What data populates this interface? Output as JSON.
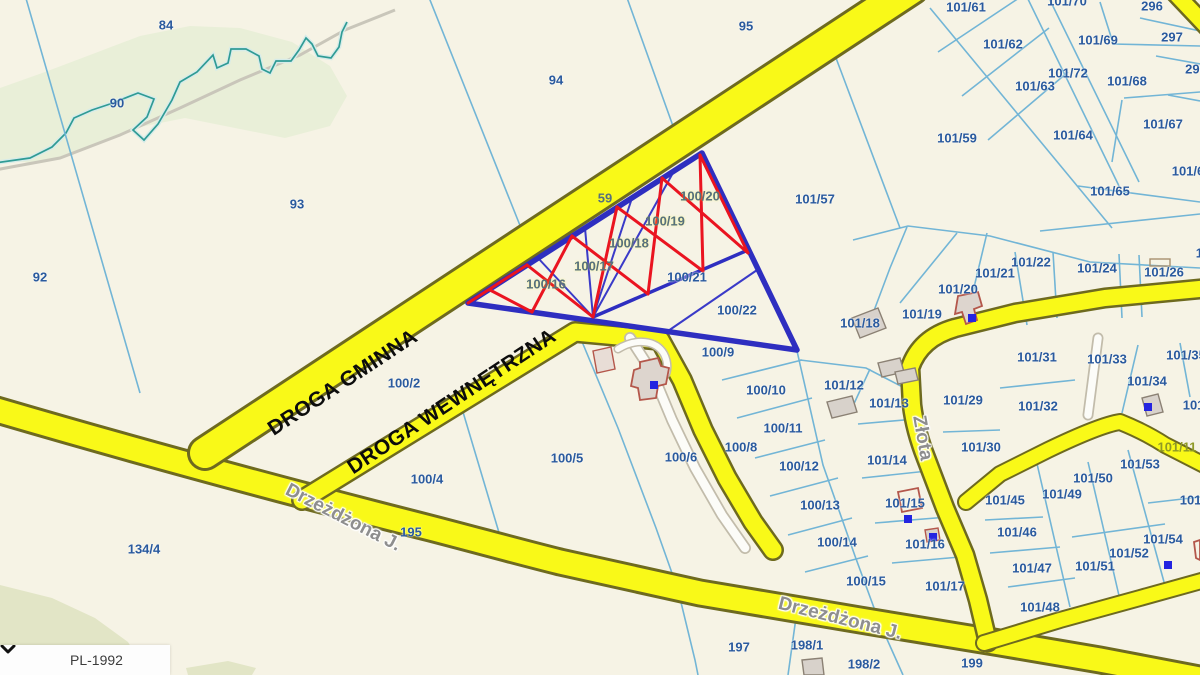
{
  "map": {
    "crs_selector": {
      "value": "PL-1992"
    },
    "labels": [
      {
        "text": "84",
        "x": 166,
        "y": 25,
        "kind": "parcel"
      },
      {
        "text": "90",
        "x": 117,
        "y": 103,
        "kind": "parcel"
      },
      {
        "text": "92",
        "x": 40,
        "y": 277,
        "kind": "parcel"
      },
      {
        "text": "93",
        "x": 297,
        "y": 204,
        "kind": "parcel"
      },
      {
        "text": "94",
        "x": 556,
        "y": 80,
        "kind": "parcel"
      },
      {
        "text": "95",
        "x": 746,
        "y": 26,
        "kind": "parcel"
      },
      {
        "text": "59",
        "x": 605,
        "y": 198,
        "kind": "parcel-muted"
      },
      {
        "text": "100/20",
        "x": 700,
        "y": 196,
        "kind": "parcel-muted"
      },
      {
        "text": "100/19",
        "x": 665,
        "y": 221,
        "kind": "parcel-muted"
      },
      {
        "text": "100/18",
        "x": 629,
        "y": 243,
        "kind": "parcel-muted"
      },
      {
        "text": "100/17",
        "x": 594,
        "y": 266,
        "kind": "parcel-muted"
      },
      {
        "text": "100/16",
        "x": 546,
        "y": 284,
        "kind": "parcel-muted"
      },
      {
        "text": "100/21",
        "x": 687,
        "y": 277,
        "kind": "parcel"
      },
      {
        "text": "100/22",
        "x": 737,
        "y": 310,
        "kind": "parcel"
      },
      {
        "text": "100/9",
        "x": 718,
        "y": 352,
        "kind": "parcel"
      },
      {
        "text": "101/57",
        "x": 815,
        "y": 199,
        "kind": "parcel"
      },
      {
        "text": "100/2",
        "x": 404,
        "y": 383,
        "kind": "parcel"
      },
      {
        "text": "100/4",
        "x": 427,
        "y": 479,
        "kind": "parcel"
      },
      {
        "text": "100/5",
        "x": 567,
        "y": 458,
        "kind": "parcel"
      },
      {
        "text": "100/6",
        "x": 681,
        "y": 457,
        "kind": "parcel"
      },
      {
        "text": "134/4",
        "x": 144,
        "y": 549,
        "kind": "parcel"
      },
      {
        "text": "195",
        "x": 411,
        "y": 532,
        "kind": "parcel"
      },
      {
        "text": "100/8",
        "x": 741,
        "y": 447,
        "kind": "parcel"
      },
      {
        "text": "100/10",
        "x": 766,
        "y": 390,
        "kind": "parcel"
      },
      {
        "text": "100/11",
        "x": 783,
        "y": 428,
        "kind": "parcel"
      },
      {
        "text": "100/12",
        "x": 799,
        "y": 466,
        "kind": "parcel"
      },
      {
        "text": "100/13",
        "x": 820,
        "y": 505,
        "kind": "parcel"
      },
      {
        "text": "100/14",
        "x": 837,
        "y": 542,
        "kind": "parcel"
      },
      {
        "text": "100/15",
        "x": 866,
        "y": 581,
        "kind": "parcel"
      },
      {
        "text": "197",
        "x": 739,
        "y": 647,
        "kind": "parcel"
      },
      {
        "text": "198/1",
        "x": 807,
        "y": 645,
        "kind": "parcel"
      },
      {
        "text": "198/2",
        "x": 864,
        "y": 664,
        "kind": "parcel"
      },
      {
        "text": "199",
        "x": 972,
        "y": 663,
        "kind": "parcel"
      },
      {
        "text": "101/12",
        "x": 844,
        "y": 385,
        "kind": "parcel"
      },
      {
        "text": "101/13",
        "x": 889,
        "y": 403,
        "kind": "parcel"
      },
      {
        "text": "101/14",
        "x": 887,
        "y": 460,
        "kind": "parcel"
      },
      {
        "text": "101/15",
        "x": 905,
        "y": 503,
        "kind": "parcel"
      },
      {
        "text": "101/16",
        "x": 925,
        "y": 544,
        "kind": "parcel"
      },
      {
        "text": "101/17",
        "x": 945,
        "y": 586,
        "kind": "parcel"
      },
      {
        "text": "101/18",
        "x": 860,
        "y": 323,
        "kind": "parcel"
      },
      {
        "text": "101/19",
        "x": 922,
        "y": 314,
        "kind": "parcel"
      },
      {
        "text": "101/20",
        "x": 958,
        "y": 289,
        "kind": "parcel"
      },
      {
        "text": "101/21",
        "x": 995,
        "y": 273,
        "kind": "parcel"
      },
      {
        "text": "101/22",
        "x": 1031,
        "y": 262,
        "kind": "parcel"
      },
      {
        "text": "101/24",
        "x": 1097,
        "y": 268,
        "kind": "parcel"
      },
      {
        "text": "101/26",
        "x": 1164,
        "y": 272,
        "kind": "parcel"
      },
      {
        "text": "101/29",
        "x": 963,
        "y": 400,
        "kind": "parcel"
      },
      {
        "text": "101/30",
        "x": 981,
        "y": 447,
        "kind": "parcel"
      },
      {
        "text": "101/31",
        "x": 1037,
        "y": 357,
        "kind": "parcel"
      },
      {
        "text": "101/32",
        "x": 1038,
        "y": 406,
        "kind": "parcel"
      },
      {
        "text": "101/33",
        "x": 1107,
        "y": 359,
        "kind": "parcel"
      },
      {
        "text": "101/34",
        "x": 1147,
        "y": 381,
        "kind": "parcel"
      },
      {
        "text": "101/35",
        "x": 1186,
        "y": 355,
        "kind": "parcel"
      },
      {
        "text": "101/4",
        "x": 1199,
        "y": 405,
        "kind": "parcel"
      },
      {
        "text": "101/45",
        "x": 1005,
        "y": 500,
        "kind": "parcel"
      },
      {
        "text": "101/46",
        "x": 1017,
        "y": 532,
        "kind": "parcel"
      },
      {
        "text": "101/47",
        "x": 1032,
        "y": 568,
        "kind": "parcel"
      },
      {
        "text": "101/48",
        "x": 1040,
        "y": 607,
        "kind": "parcel"
      },
      {
        "text": "101/49",
        "x": 1062,
        "y": 494,
        "kind": "parcel"
      },
      {
        "text": "101/50",
        "x": 1093,
        "y": 478,
        "kind": "parcel"
      },
      {
        "text": "101/51",
        "x": 1095,
        "y": 566,
        "kind": "parcel"
      },
      {
        "text": "101/52",
        "x": 1129,
        "y": 553,
        "kind": "parcel"
      },
      {
        "text": "101/53",
        "x": 1140,
        "y": 464,
        "kind": "parcel"
      },
      {
        "text": "101/54",
        "x": 1163,
        "y": 539,
        "kind": "parcel"
      },
      {
        "text": "101/5",
        "x": 1196,
        "y": 500,
        "kind": "parcel"
      },
      {
        "text": "101/59",
        "x": 957,
        "y": 138,
        "kind": "parcel"
      },
      {
        "text": "101/61",
        "x": 966,
        "y": 7,
        "kind": "parcel"
      },
      {
        "text": "101/62",
        "x": 1003,
        "y": 44,
        "kind": "parcel"
      },
      {
        "text": "101/63",
        "x": 1035,
        "y": 86,
        "kind": "parcel"
      },
      {
        "text": "101/64",
        "x": 1073,
        "y": 135,
        "kind": "parcel"
      },
      {
        "text": "101/65",
        "x": 1110,
        "y": 191,
        "kind": "parcel"
      },
      {
        "text": "101/67",
        "x": 1163,
        "y": 124,
        "kind": "parcel"
      },
      {
        "text": "101/68",
        "x": 1127,
        "y": 81,
        "kind": "parcel"
      },
      {
        "text": "101/69",
        "x": 1098,
        "y": 40,
        "kind": "parcel"
      },
      {
        "text": "101/70",
        "x": 1067,
        "y": 1,
        "kind": "parcel"
      },
      {
        "text": "101/72",
        "x": 1068,
        "y": 73,
        "kind": "parcel"
      },
      {
        "text": "296",
        "x": 1152,
        "y": 6,
        "kind": "parcel"
      },
      {
        "text": "297",
        "x": 1172,
        "y": 37,
        "kind": "parcel"
      },
      {
        "text": "298",
        "x": 1196,
        "y": 69,
        "kind": "parcel"
      },
      {
        "text": "101/6",
        "x": 1188,
        "y": 171,
        "kind": "parcel"
      },
      {
        "text": "10",
        "x": 1203,
        "y": 253,
        "kind": "parcel"
      },
      {
        "text": "101/11",
        "x": 1177,
        "y": 447,
        "kind": "parcel-onroad"
      },
      {
        "text": "DROGA GMINNA",
        "x": 343,
        "y": 383,
        "rot": -33.5,
        "kind": "road-name"
      },
      {
        "text": "DROGA WEWNĘTRZNA",
        "x": 452,
        "y": 402,
        "rot": -33.5,
        "kind": "road-name"
      },
      {
        "text": "Drzeżdżona J.",
        "x": 343,
        "y": 518,
        "rot": 27,
        "kind": "street-name"
      },
      {
        "text": "Drzeżdżona J.",
        "x": 840,
        "y": 619,
        "rot": 14,
        "kind": "street-name"
      },
      {
        "text": "Złota",
        "x": 922,
        "y": 438,
        "rot": 80,
        "kind": "street-name"
      }
    ],
    "colors": {
      "background": "#f6f3e5",
      "green_area": "#e9efd8",
      "olive_area": "#e2e5c6",
      "road_fill": "#f9f918",
      "road_casing": "#6e6a1f",
      "parcel_line": "#72b5d6",
      "parcel_text": "#2a5a9e",
      "selection_outline": "#2e2ec0",
      "hatch_red": "#ea1420",
      "stream": "#2f9b95",
      "marker_blue": "#2424e0",
      "building_fill": "#d8d2cb",
      "building_outline_red": "#b4574b"
    }
  }
}
